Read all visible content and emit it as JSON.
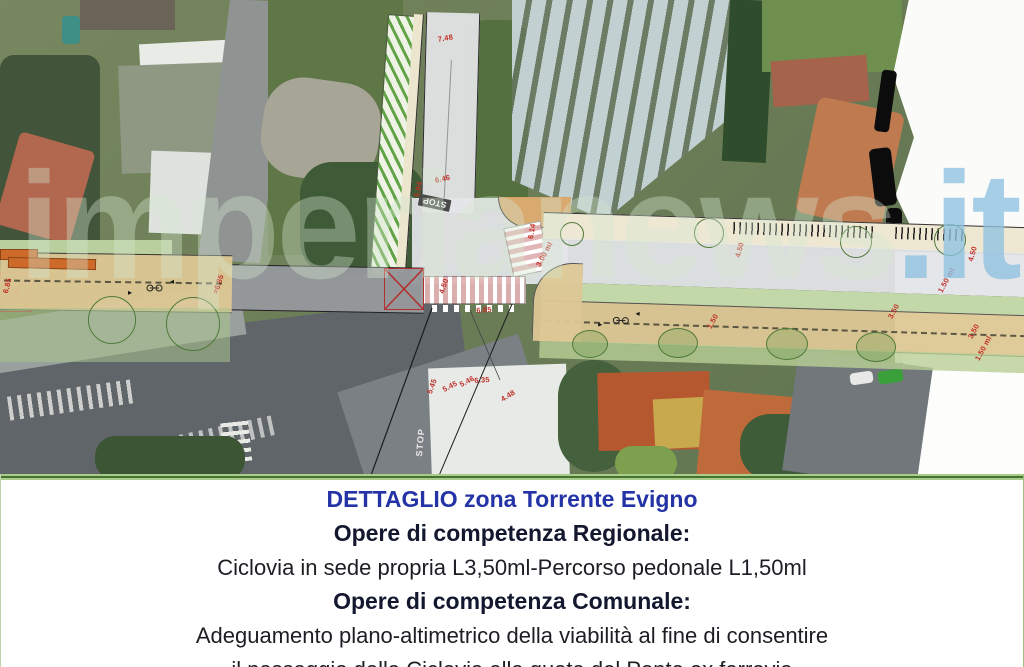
{
  "panel": {
    "lines": [
      {
        "text": "DETTAGLIO zona Torrente Evigno",
        "style": "title"
      },
      {
        "text": "Opere di competenza Regionale:",
        "style": "bold"
      },
      {
        "text": "Ciclovia in sede propria L3,50ml-Percorso pedonale L1,50ml",
        "style": "regular"
      },
      {
        "text": "Opere di competenza Comunale:",
        "style": "bold"
      },
      {
        "text": "Adeguamento plano-altimetrico della viabilità al fine di consentire",
        "style": "regular"
      },
      {
        "text": "il passaggio della Ciclovia alla quota del Ponte ex ferrovia",
        "style": "regular"
      }
    ]
  },
  "watermark": {
    "main": "imperianews",
    "tld": ".it"
  },
  "plan": {
    "dimension_color": "#c03029",
    "dimensions": [
      {
        "t": "7.48",
        "x": 437,
        "y": 35,
        "r": -10
      },
      {
        "t": "6.46",
        "x": 434,
        "y": 176,
        "r": -12
      },
      {
        "t": "5.84",
        "x": 412,
        "y": 196,
        "r": -78
      },
      {
        "t": "STOP",
        "x": 449,
        "y": 212,
        "r": -168,
        "kind": "plaque"
      },
      {
        "t": "6.14",
        "x": 526,
        "y": 238,
        "r": -80
      },
      {
        "t": "3.00 ml",
        "x": 534,
        "y": 264,
        "r": -62
      },
      {
        "t": "4.50",
        "x": 437,
        "y": 292,
        "r": -72
      },
      {
        "t": "6.85",
        "x": 476,
        "y": 306,
        "r": -4
      },
      {
        "t": "6.85",
        "x": 1,
        "y": 292,
        "r": -76
      },
      {
        "t": "≈6.85",
        "x": 211,
        "y": 292,
        "r": -72
      },
      {
        "t": "6.35",
        "x": 474,
        "y": 376,
        "r": -4
      },
      {
        "t": "5.45",
        "x": 441,
        "y": 386,
        "r": -28
      },
      {
        "t": "5.46",
        "x": 458,
        "y": 381,
        "r": -28
      },
      {
        "t": "4.48",
        "x": 499,
        "y": 396,
        "r": -32
      },
      {
        "t": "5.45",
        "x": 425,
        "y": 392,
        "r": -70
      },
      {
        "t": "4.50",
        "x": 733,
        "y": 256,
        "r": -74
      },
      {
        "t": "4.50",
        "x": 966,
        "y": 260,
        "r": -74
      },
      {
        "t": "1.50 ml",
        "x": 936,
        "y": 290,
        "r": -62
      },
      {
        "t": "3.50",
        "x": 886,
        "y": 316,
        "r": -62
      },
      {
        "t": "1.50",
        "x": 705,
        "y": 326,
        "r": -62
      },
      {
        "t": "3.50",
        "x": 966,
        "y": 336,
        "r": -62
      },
      {
        "t": "1.50 ml",
        "x": 973,
        "y": 358,
        "r": -62
      },
      {
        "t": "STOP",
        "x": 414,
        "y": 456,
        "r": -85,
        "kind": "road"
      }
    ]
  }
}
